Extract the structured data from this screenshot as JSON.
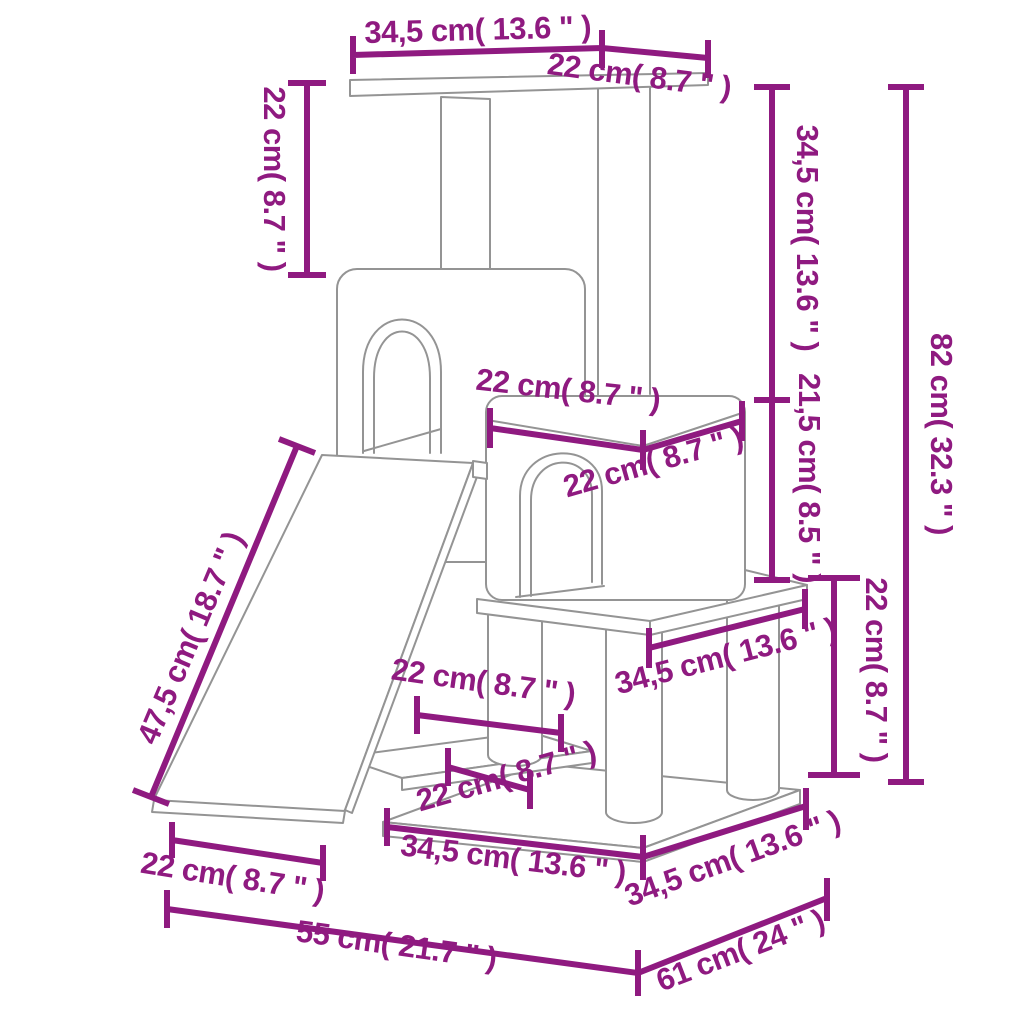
{
  "colors": {
    "dimension_color": "#8F1A80",
    "line_color": "#949494",
    "background": "#FFFFFF"
  },
  "diagram": {
    "kind": "product dimension line drawing",
    "subject": "cat tree with condos, ramp, platforms and posts"
  },
  "dimensions": {
    "top_platform_width": "34,5 cm( 13.6 \" )",
    "top_platform_depth": "22 cm( 8.7 \" )",
    "front_post_height": "22 cm( 8.7 \" )",
    "upper_section_height": "34,5 cm( 13.6 \" )",
    "condo_height": "21,5 cm( 8.5 \" )",
    "total_height": "82 cm( 32.3 \" )",
    "condo_top_width": "22 cm( 8.7 \" )",
    "condo_top_depth": "22 cm( 8.7 \" )",
    "lower_section_height": "22 cm( 8.7 \" )",
    "middle_platform_width": "34,5 cm( 13.6 \" )",
    "shelf_width": "22 cm( 8.7 \" )",
    "shelf_depth": "22 cm( 8.7 \" )",
    "ramp_length": "47,5 cm( 18.7 \" )",
    "ramp_width": "22 cm( 8.7 \" )",
    "base_width": "34,5 cm( 13.6 \" )",
    "base_depth": "34,5 cm( 13.6 \" )",
    "overall_width": "55 cm( 21.7 \" )",
    "overall_depth": "61 cm( 24 \" )"
  }
}
